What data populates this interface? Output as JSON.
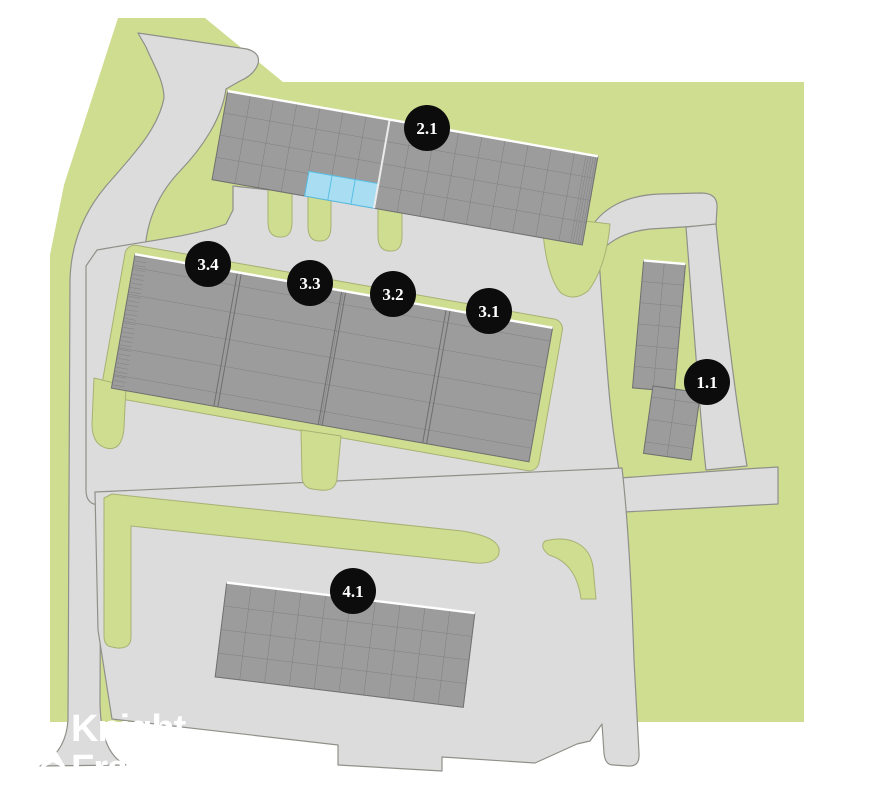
{
  "colors": {
    "background": "#ffffff",
    "grass": "#cedd90",
    "grass_outline": "#a8b173",
    "road": "#dcdcdc",
    "road_outline": "#90908a",
    "building": "#9c9c9c",
    "building_grid": "#767676",
    "building_outline": "#6e6e6e",
    "building_top_highlight": "#ffffff",
    "unit_highlight": "#a9def2",
    "unit_highlight_outline": "#58bee4",
    "marker_fill": "#0c0c0c",
    "marker_text": "#ffffff",
    "watermark": "#ffffff"
  },
  "markers": [
    {
      "label": "2.1",
      "x": 427,
      "y": 128
    },
    {
      "label": "3.4",
      "x": 208,
      "y": 264
    },
    {
      "label": "3.3",
      "x": 310,
      "y": 283
    },
    {
      "label": "3.2",
      "x": 393,
      "y": 294
    },
    {
      "label": "3.1",
      "x": 489,
      "y": 311
    },
    {
      "label": "1.1",
      "x": 707,
      "y": 382
    },
    {
      "label": "4.1",
      "x": 353,
      "y": 591
    }
  ],
  "watermark": {
    "line1": "Knight",
    "line2": "Frank"
  }
}
